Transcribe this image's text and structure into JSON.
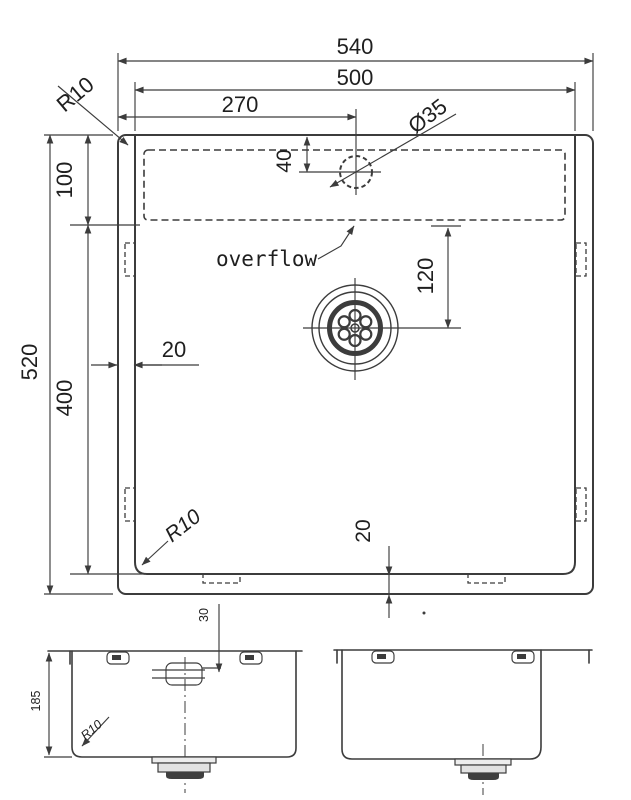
{
  "colors": {
    "line": "#3c3c3c",
    "text": "#1f1f1f",
    "background": "#ffffff"
  },
  "plan_view": {
    "dims": {
      "overall_width": "540",
      "bowl_width": "500",
      "faucet_offset": "270",
      "corner_radius_top": "R10",
      "faucet_hole_diameter": "Ø35",
      "faucet_hole_from_top": "40",
      "deck_depth": "100",
      "overall_length": "520",
      "bowl_length": "400",
      "rim_gap_left": "20",
      "overflow_to_drain": "120",
      "rim_gap_bottom": "20",
      "corner_radius_bowl": "R10"
    },
    "labels": {
      "overflow": "overflow"
    }
  },
  "front_view": {
    "dims": {
      "overflow_from_rim": "30",
      "bowl_depth": "185",
      "corner_radius": "R10"
    }
  }
}
